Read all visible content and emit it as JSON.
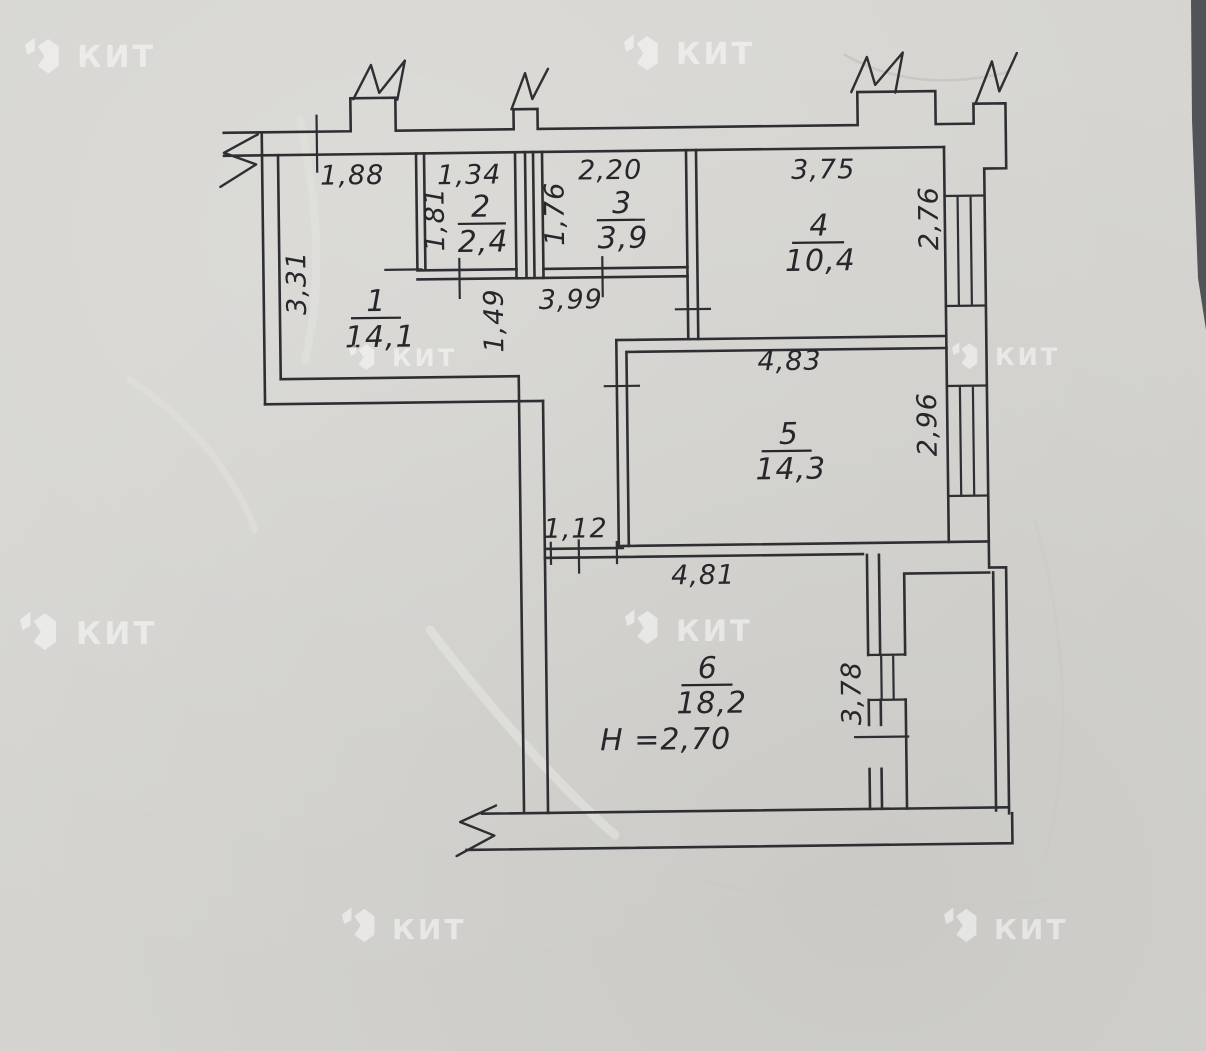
{
  "watermark": {
    "text": "КИТ"
  },
  "plan": {
    "rooms": [
      {
        "number": "1",
        "area": "14,1"
      },
      {
        "number": "2",
        "area": "2,4"
      },
      {
        "number": "3",
        "area": "3,9"
      },
      {
        "number": "4",
        "area": "10,4"
      },
      {
        "number": "5",
        "area": "14,3"
      },
      {
        "number": "6",
        "area": "18,2"
      }
    ],
    "ceiling_height": "H =2,70",
    "dimensions": {
      "room1_top": "1,88",
      "room1_left": "3,31",
      "room2_top": "1,34",
      "room2_left": "1,81",
      "room3_top": "2,20",
      "room3_left": "1,76",
      "room4_top": "3,75",
      "room4_right": "2,76",
      "hall_width": "3,99",
      "hall_height": "1,49",
      "room5_top": "4,83",
      "room5_right": "2,96",
      "room6_doorway": "1,12",
      "room6_top": "4,81",
      "room6_right": "3,78"
    }
  }
}
